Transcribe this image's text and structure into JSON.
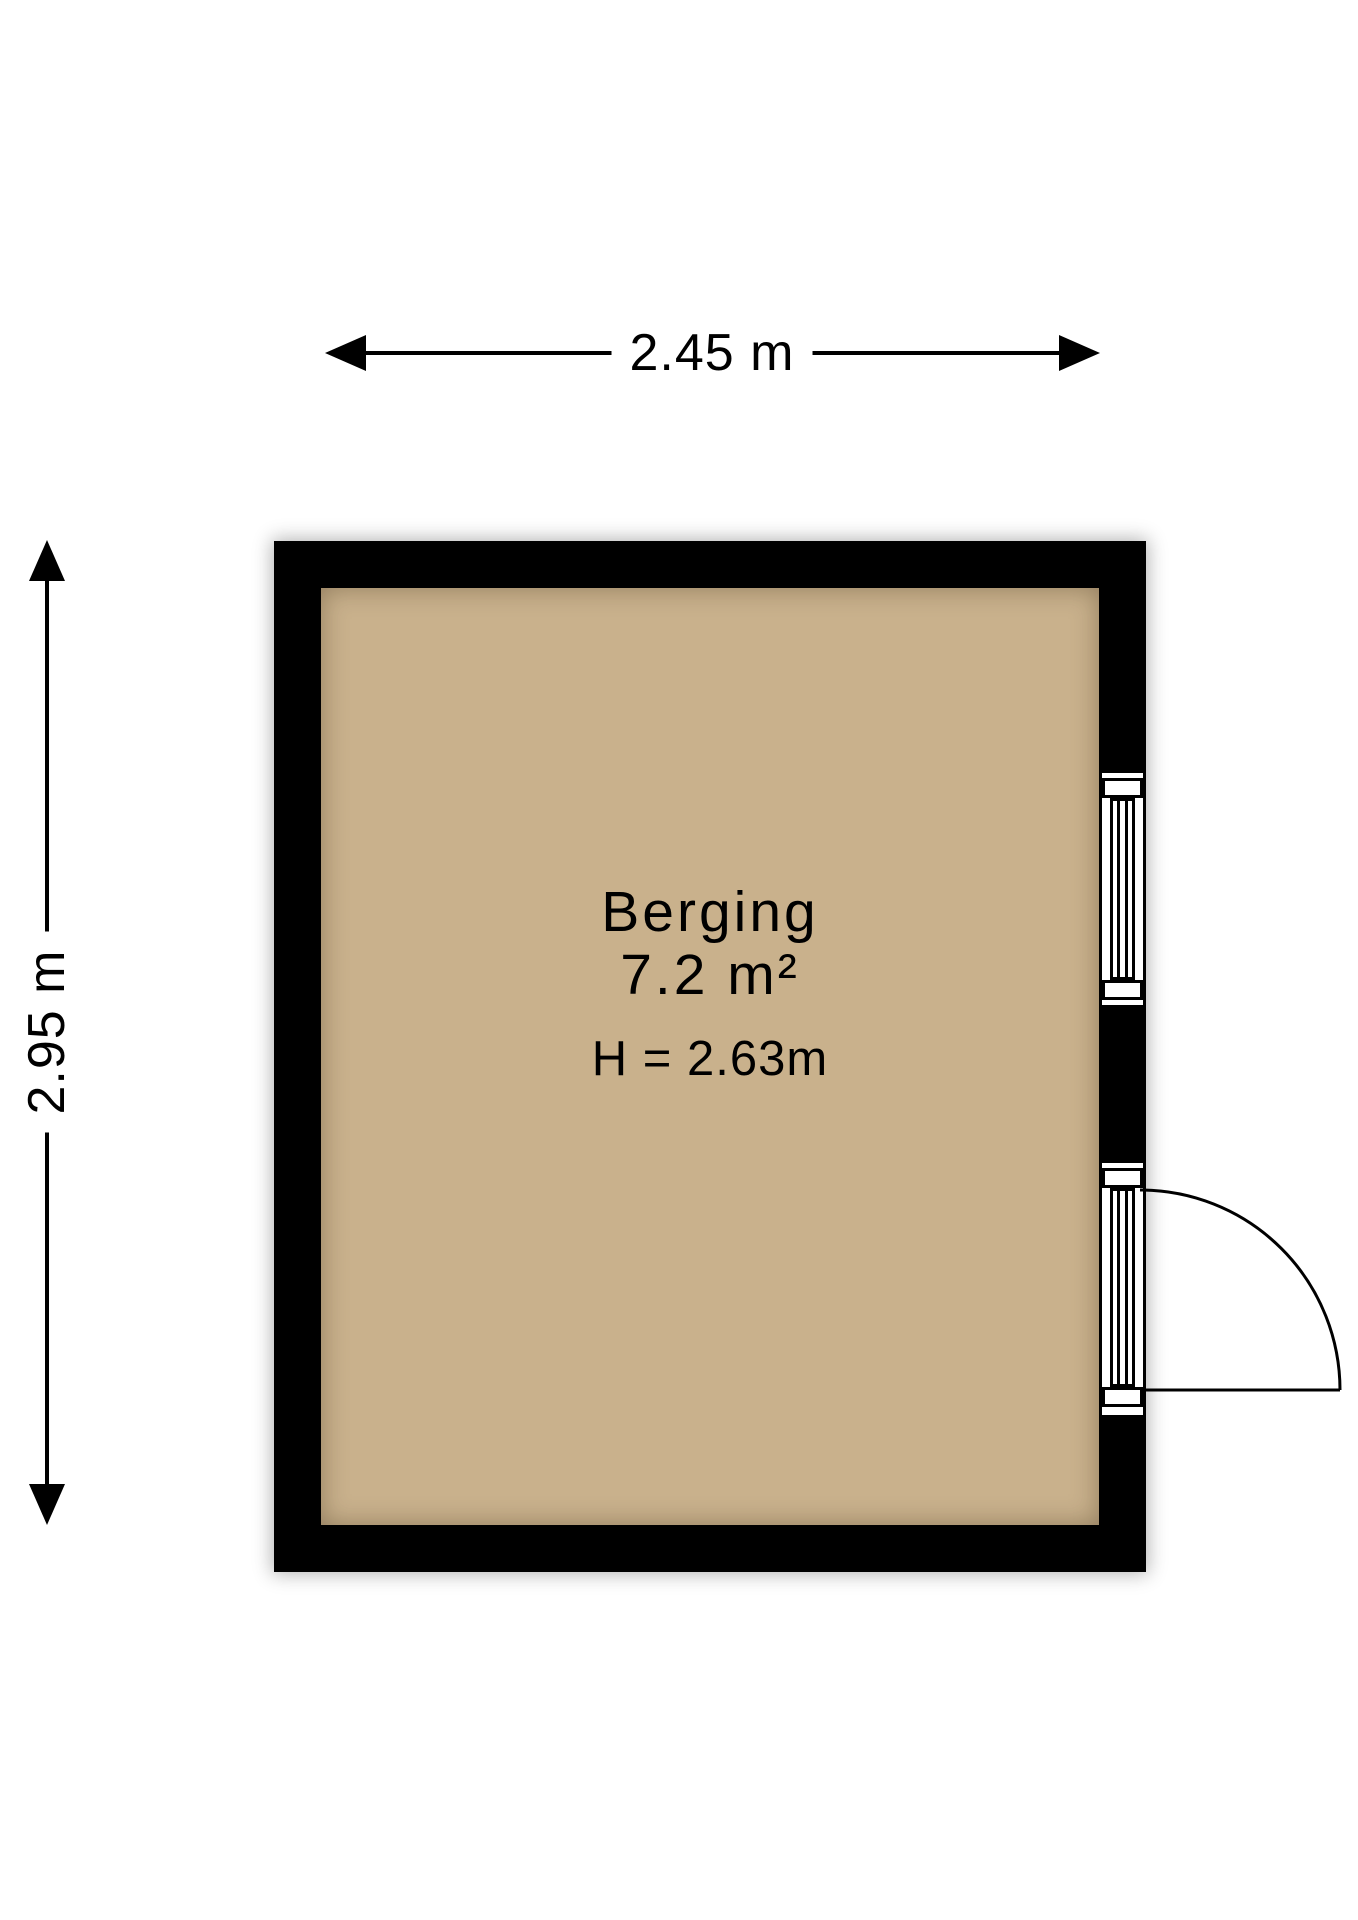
{
  "floorplan": {
    "room": {
      "name": "Berging",
      "area": "7.2 m²",
      "ceiling_height": "H = 2.63m"
    },
    "dimensions": {
      "width_label": "2.45 m",
      "height_label": "2.95 m"
    },
    "colors": {
      "wall": "#000000",
      "floor": "#c9b18c",
      "line": "#000000",
      "text": "#000000",
      "background": "#ffffff"
    }
  }
}
